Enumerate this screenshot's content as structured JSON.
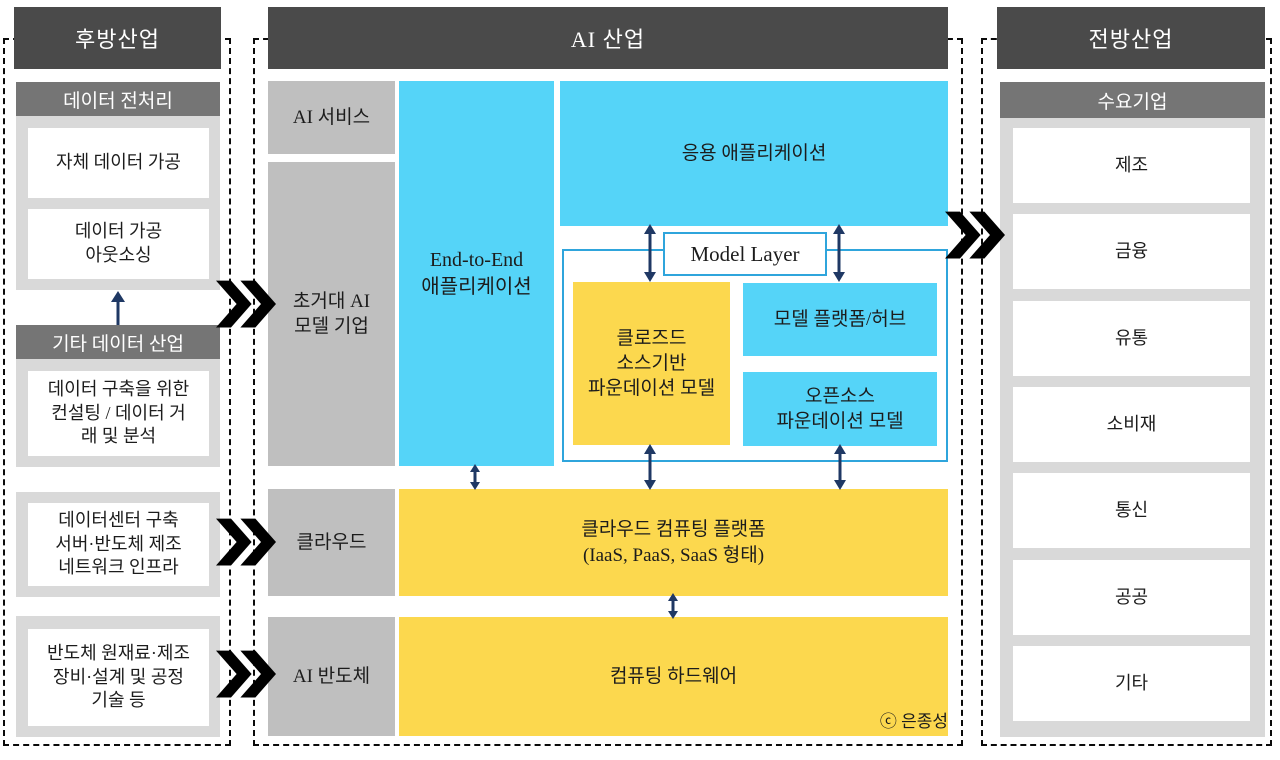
{
  "backward": {
    "title": "후방산업",
    "group1": {
      "header": "데이터 전처리",
      "box1": "자체 데이터 가공",
      "box2": "데이터 가공\n아웃소싱"
    },
    "group2": {
      "header": "기타 데이터 산업",
      "box1": "데이터 구축을 위한\n컨설팅 / 데이터 거\n래 및 분석"
    },
    "group3": {
      "box1": "데이터센터 구축\n서버·반도체 제조\n네트워크 인프라"
    },
    "group4": {
      "box1": "반도체 원재료·제조\n장비·설계 및 공정\n기술 등"
    }
  },
  "ai": {
    "title": "AI 산업",
    "labels": {
      "service": "AI 서비스",
      "hyperscale": "초거대 AI\n모델 기업",
      "cloud": "클라우드",
      "semiconductor": "AI 반도체"
    },
    "blocks": {
      "end_to_end": "End-to-End\n애플리케이션",
      "application": "응용 애플리케이션",
      "model_layer": "Model Layer",
      "closed_source": "클로즈드\n소스기반\n파운데이션 모델",
      "platform_hub": "모델 플랫폼/허브",
      "open_source": "오픈소스\n파운데이션 모델",
      "cloud_platform": "클라우드 컴퓨팅 플랫폼\n(IaaS, PaaS, SaaS 형태)",
      "hardware": "컴퓨팅 하드웨어"
    },
    "credit": "ⓒ 은종성"
  },
  "forward": {
    "title": "전방산업",
    "header": "수요기업",
    "items": [
      "제조",
      "금융",
      "유통",
      "소비재",
      "통신",
      "공공",
      "기타"
    ]
  },
  "colors": {
    "header_bg": "#4a4a4a",
    "subheader_bg": "#757575",
    "panel_bg": "#d9d9d9",
    "gray_box": "#bfbfbf",
    "blue_box": "#55d4f8",
    "yellow_box": "#fcd84e",
    "arrow_navy": "#1f3864",
    "model_layer_border": "#2fa5dc",
    "chevron": "#000000"
  }
}
